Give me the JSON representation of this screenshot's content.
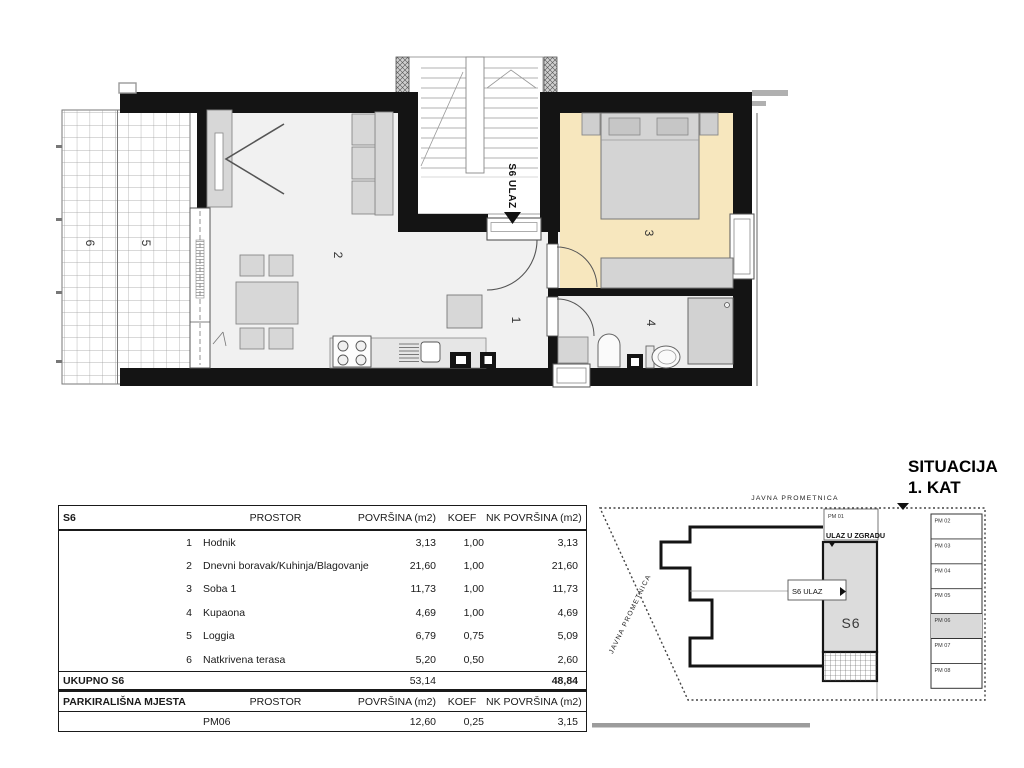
{
  "floor_plan": {
    "rooms": {
      "hall": "1",
      "living": "2",
      "bedroom": "3",
      "bath": "4",
      "loggia": "5",
      "terrace": "6"
    },
    "entrance_label": "S6 ULAZ"
  },
  "table": {
    "unit": "S6",
    "col_prostor": "PROSTOR",
    "col_povrsina": "POVRŠINA (m2)",
    "col_koef": "KOEF",
    "col_nk": "NK POVRŠINA (m2)",
    "rows": [
      {
        "num": "1",
        "name": "Hodnik",
        "area": "3,13",
        "koef": "1,00",
        "nk": "3,13"
      },
      {
        "num": "2",
        "name": "Dnevni boravak/Kuhinja/Blagovanje",
        "area": "21,60",
        "koef": "1,00",
        "nk": "21,60"
      },
      {
        "num": "3",
        "name": "Soba 1",
        "area": "11,73",
        "koef": "1,00",
        "nk": "11,73"
      },
      {
        "num": "4",
        "name": "Kupaona",
        "area": "4,69",
        "koef": "1,00",
        "nk": "4,69"
      },
      {
        "num": "5",
        "name": "Loggia",
        "area": "6,79",
        "koef": "0,75",
        "nk": "5,09"
      },
      {
        "num": "6",
        "name": "Natkrivena terasa",
        "area": "5,20",
        "koef": "0,50",
        "nk": "2,60"
      }
    ],
    "total_label": "UKUPNO S6",
    "total_area": "53,14",
    "total_nk": "48,84",
    "parking_title": "PARKIRALIŠNA MJESTA",
    "parking_row": {
      "name": "PM06",
      "area": "12,60",
      "koef": "0,25",
      "nk": "3,15"
    }
  },
  "situation": {
    "title1": "SITUACIJA",
    "title2": "1. KAT",
    "road_top": "JAVNA PROMETNICA",
    "road_left": "JAVNA PROMETNICA",
    "entrance_building": "ULAZ U ZGRADU",
    "entrance_unit": "S6 ULAZ",
    "unit": "S6",
    "pm01": "PM 01",
    "spots": [
      "PM 02",
      "PM 03",
      "PM 04",
      "PM 05",
      "PM 06",
      "PM 07",
      "PM 08"
    ]
  },
  "colors": {
    "bedroom": "#f7e7be",
    "wall": "#141414",
    "highlight": "#dcdcdc"
  }
}
